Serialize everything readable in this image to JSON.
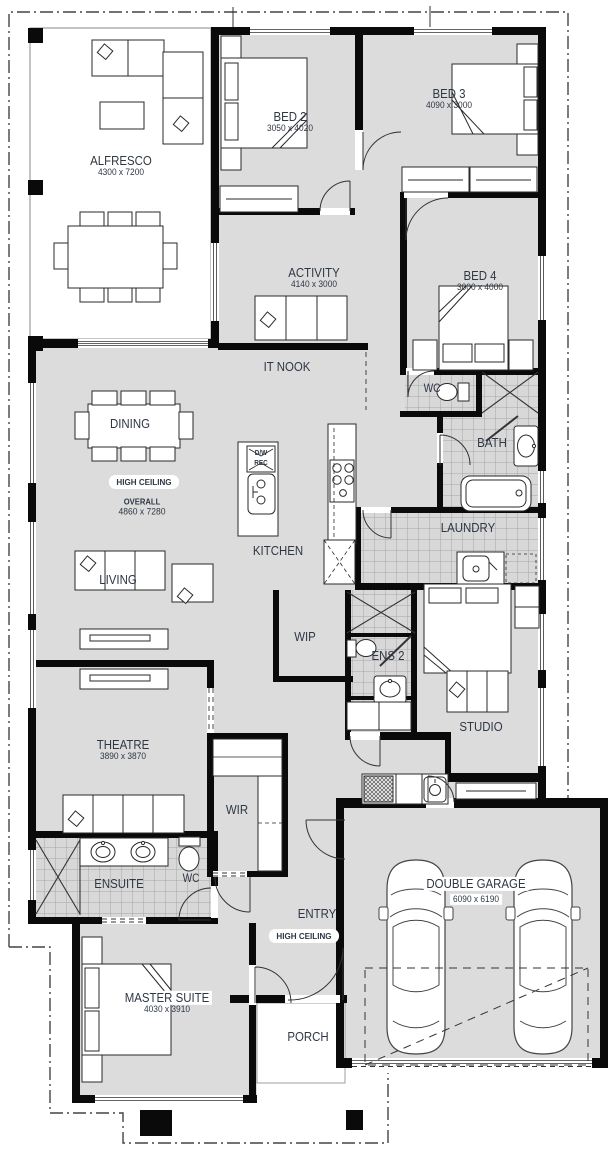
{
  "title": "Single storey home floor plan",
  "colors": {
    "floor": "#dcdcdc",
    "tile_floor": "#d8d8d8",
    "wall": "#0a0a0a",
    "label_text": "#2e3744",
    "boundary_line": "#444444"
  },
  "rooms": [
    {
      "id": "alfresco",
      "label": "ALFRESCO",
      "dims": "4300 x 7200"
    },
    {
      "id": "bed2",
      "label": "BED 2",
      "dims": "3050 x 4020"
    },
    {
      "id": "bed3",
      "label": "BED 3",
      "dims": "4090 x 3000"
    },
    {
      "id": "activity",
      "label": "ACTIVITY",
      "dims": "4140 x 3000"
    },
    {
      "id": "bed4",
      "label": "BED 4",
      "dims": "3000 x 4000"
    },
    {
      "id": "it-nook",
      "label": "IT NOOK"
    },
    {
      "id": "wc-main",
      "label": "WC"
    },
    {
      "id": "bath",
      "label": "BATH"
    },
    {
      "id": "dining",
      "label": "DINING"
    },
    {
      "id": "kitchen",
      "label": "KITCHEN"
    },
    {
      "id": "living",
      "label": "LIVING"
    },
    {
      "id": "laundry",
      "label": "LAUNDRY"
    },
    {
      "id": "wip",
      "label": "WIP"
    },
    {
      "id": "ens2",
      "label": "ENS 2"
    },
    {
      "id": "studio",
      "label": "STUDIO"
    },
    {
      "id": "theatre",
      "label": "THEATRE",
      "dims": "3890 x 3870"
    },
    {
      "id": "wir",
      "label": "WIR"
    },
    {
      "id": "ensuite",
      "label": "ENSUITE"
    },
    {
      "id": "wc-ensuite",
      "label": "WC"
    },
    {
      "id": "entry",
      "label": "ENTRY"
    },
    {
      "id": "master-suite",
      "label": "MASTER SUITE",
      "dims": "4030 x 3910"
    },
    {
      "id": "porch",
      "label": "PORCH"
    },
    {
      "id": "double-garage",
      "label": "DOUBLE GARAGE",
      "dims": "6090 x 6190"
    }
  ],
  "annotations": {
    "high_ceiling_living": "HIGH CEILING",
    "high_ceiling_entry": "HIGH CEILING",
    "overall_label": "OVERALL",
    "overall_dims": "4860 x 7280",
    "island_dw": "D/W",
    "island_rec": "REC"
  }
}
